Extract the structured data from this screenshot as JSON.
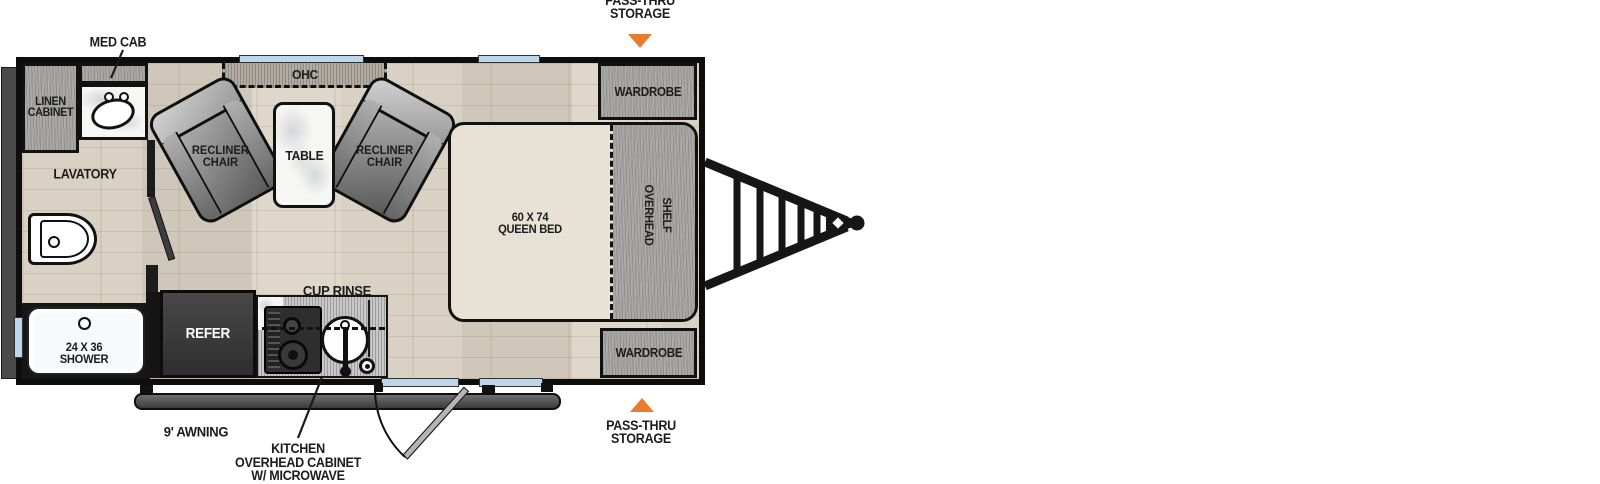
{
  "diagram": {
    "type": "travel trailer floor plan",
    "exterior": {
      "pass_thru_top": [
        "PASS-THRU",
        "STORAGE"
      ],
      "pass_thru_bottom": [
        "PASS-THRU",
        "STORAGE"
      ],
      "awning": "9' AWNING"
    },
    "bathroom": {
      "med_cab": "MED CAB",
      "linen_cabinet": [
        "LINEN",
        "CABINET"
      ],
      "lavatory": "LAVATORY",
      "shower": [
        "24 X 36",
        "SHOWER"
      ]
    },
    "living": {
      "ohc": "OHC",
      "recliner_left": [
        "RECLINER",
        "CHAIR"
      ],
      "recliner_right": [
        "RECLINER",
        "CHAIR"
      ],
      "table": "TABLE"
    },
    "kitchen": {
      "refer": "REFER",
      "cup_rinse": "CUP RINSE",
      "kitchen_ohc": [
        "KITCHEN",
        "OVERHEAD CABINET",
        "W/ MICROWAVE"
      ]
    },
    "bedroom": {
      "queen_bed": [
        "60 X 74",
        "QUEEN BED"
      ],
      "overhead_shelf": [
        "OVERHEAD",
        "SHELF"
      ],
      "wardrobe_top": "WARDROBE",
      "wardrobe_bottom": "WARDROBE"
    },
    "colors": {
      "arrow_orange": "#E87B2C",
      "window_blue": "#BCD6EC",
      "wall_black": "#111111",
      "floor_wood": "#D8D1C4",
      "cabinet_gray": "#A7A6A4",
      "mattress": "#E7E1D6"
    }
  }
}
